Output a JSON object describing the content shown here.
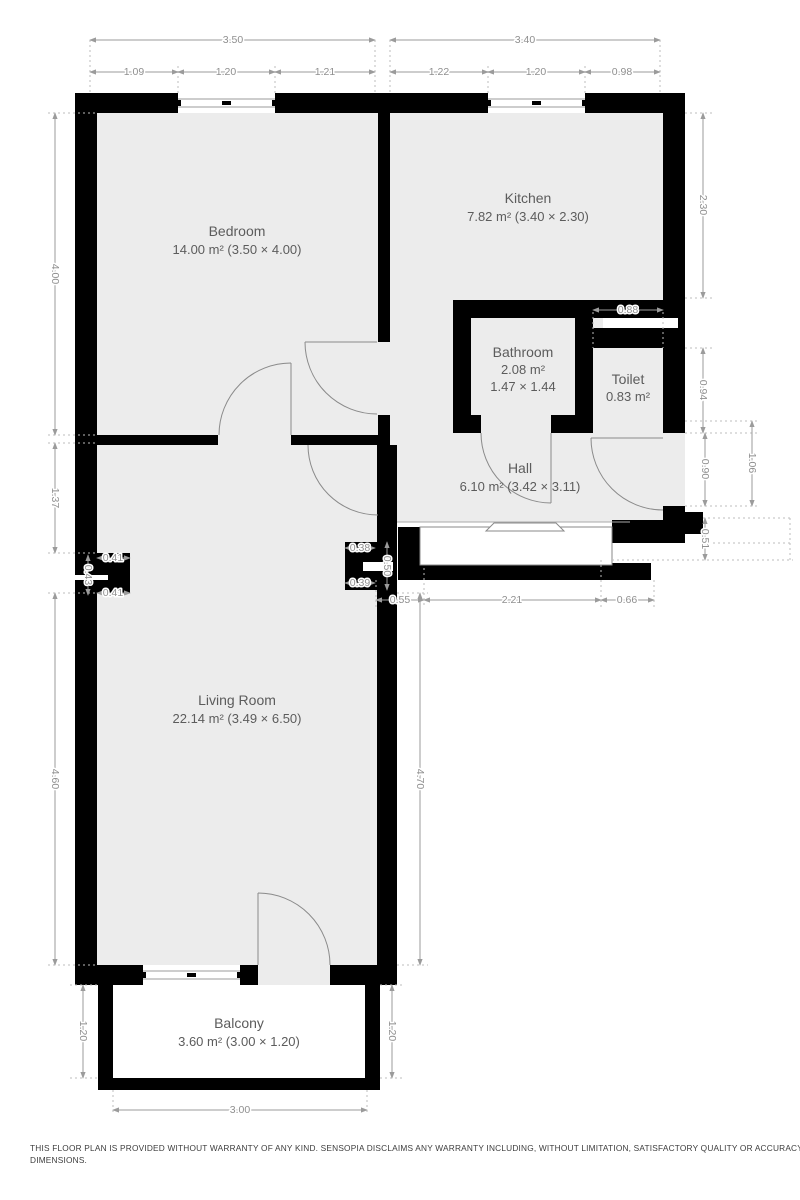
{
  "rooms": {
    "bedroom": {
      "name": "Bedroom",
      "area": "14.00 m² (3.50 × 4.00)"
    },
    "kitchen": {
      "name": "Kitchen",
      "area": "7.82 m² (3.40 × 2.30)"
    },
    "bathroom": {
      "name": "Bathroom",
      "area": "2.08 m²",
      "size": "1.47 × 1.44"
    },
    "toilet": {
      "name": "Toilet",
      "area": "0.83 m²"
    },
    "hall": {
      "name": "Hall",
      "area": "6.10 m² (3.42 × 3.11)"
    },
    "living": {
      "name": "Living Room",
      "area": "22.14 m² (3.49 × 6.50)"
    },
    "balcony": {
      "name": "Balcony",
      "area": "3.60 m² (3.00 × 1.20)"
    }
  },
  "dimensions": {
    "top": {
      "bedroom_width": "3.50",
      "kitchen_width": "3.40",
      "bedroom_segments": [
        "1.09",
        "1.20",
        "1.21"
      ],
      "kitchen_segments": [
        "1.22",
        "1.20",
        "0.98"
      ]
    },
    "left": {
      "bedroom_height": "4.00",
      "hall_strip": "1.37",
      "pier_top": "0.41",
      "pier_height": "0.43",
      "pier_bottom": "0.41",
      "living_height": "4.60",
      "balcony_height": "1.20"
    },
    "right": {
      "kitchen_height": "2.30",
      "toilet_width": "0.88",
      "toilet_height": "0.94",
      "entry_door": "0.90",
      "entry_total": "1.06",
      "below_entry": "0.51"
    },
    "living": {
      "height_right": "4.70",
      "pier_top": "0.38",
      "pier_height": "0.50",
      "pier_bottom": "0.39"
    },
    "entry_bottom": {
      "left": "0.55",
      "landing": "2.21",
      "right": "0.66"
    },
    "balcony": {
      "width": "3.00",
      "height_right": "1.20"
    }
  },
  "colors": {
    "wall": "#000000",
    "room_fill": "#ececec",
    "dimension": "#8f8f8f",
    "room_text": "#5c5c5c",
    "background": "#ffffff"
  },
  "footer": {
    "line1": "THIS FLOOR PLAN IS PROVIDED WITHOUT WARRANTY OF ANY KIND. SENSOPIA DISCLAIMS ANY WARRANTY INCLUDING, WITHOUT LIMITATION, SATISFACTORY QUALITY OR ACCURACY OF",
    "line2": "DIMENSIONS."
  }
}
